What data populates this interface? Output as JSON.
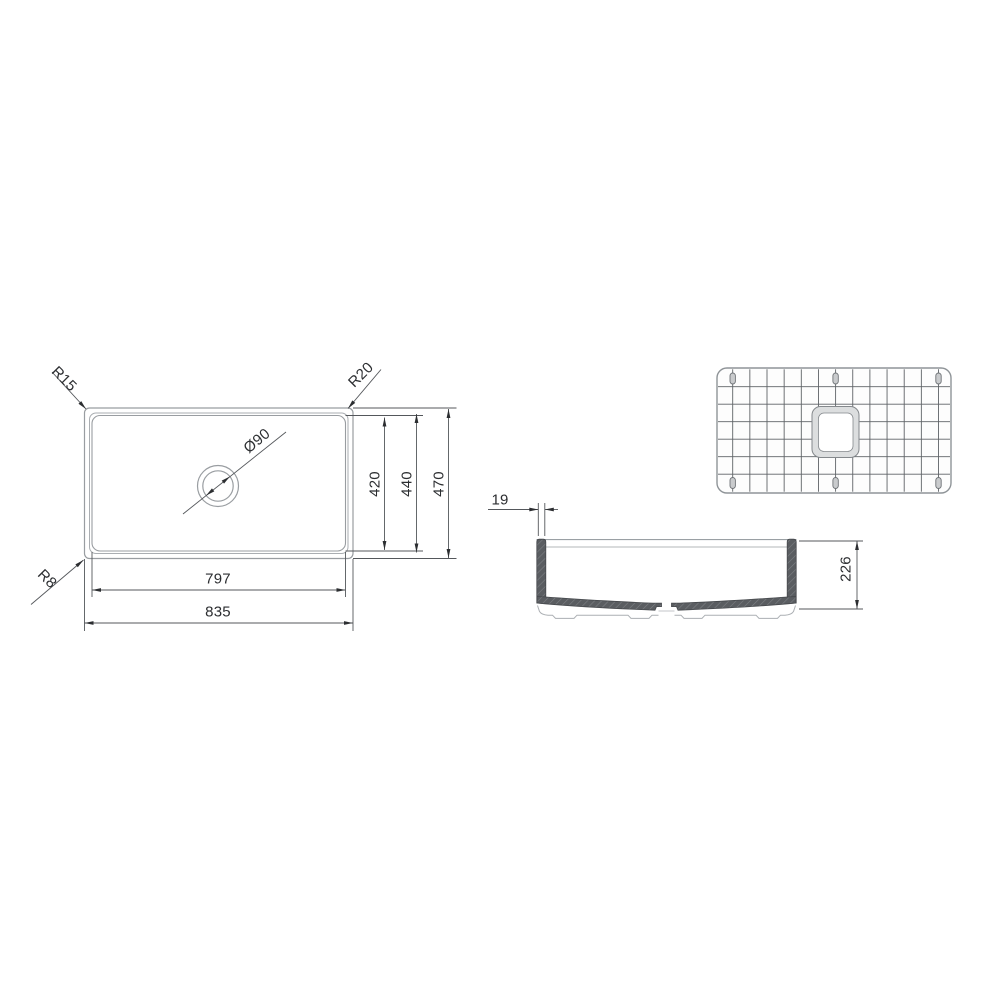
{
  "drawing": {
    "plan": {
      "radius_top_left": "R15",
      "radius_top_right": "R20",
      "radius_bottom_left": "R8",
      "drain_diameter": "Ø90",
      "dim_bowl_length": "797",
      "dim_overall_length": "835",
      "dim_bowl_width": "420",
      "dim_mid_width": "440",
      "dim_overall_width": "470"
    },
    "section": {
      "dim_wall_thickness": "19",
      "dim_depth": "226"
    },
    "colors": {
      "outline_gray": "#999da1",
      "dimension_line": "#54575b",
      "text": "#2c2e31",
      "section_wall_fill": "#5a5d61",
      "grid_wire": "#5f6367",
      "background": "#ffffff"
    }
  }
}
